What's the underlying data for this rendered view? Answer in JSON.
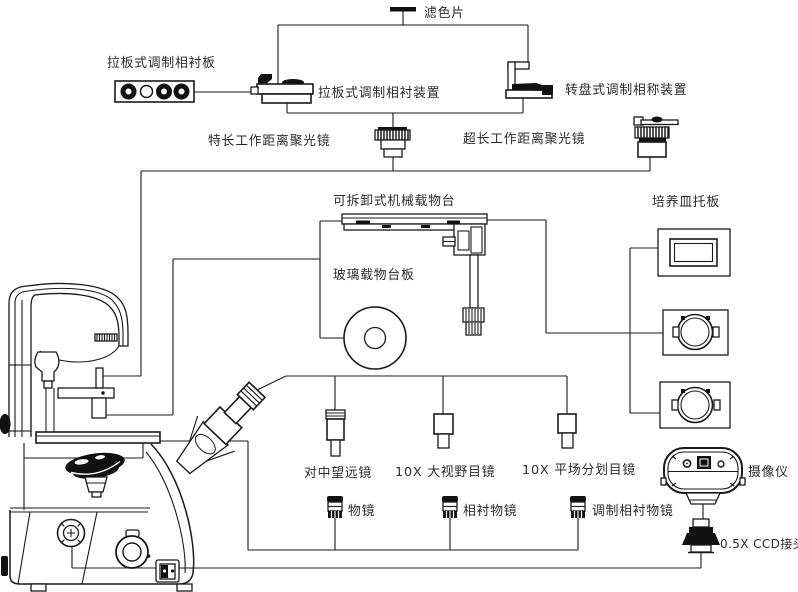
{
  "diagram": {
    "kind": "inverted-microscope-accessory-diagram",
    "colors": {
      "line": "#1a1a1a",
      "dark_fill": "#111111",
      "background": "#ffffff",
      "text": "#2b2b2b"
    },
    "labels": {
      "filter": "滤色片",
      "slider_plate": "拉板式调制相衬板",
      "slider_device": "拉板式调制相衬装置",
      "turret_device": "转盘式调制相称装置",
      "condenser_long": "特长工作距离聚光镜",
      "condenser_ultra": "超长工作距离聚光镜",
      "mech_stage": "可拆卸式机械载物台",
      "petri_holder": "培养皿托板",
      "glass_plate": "玻璃载物台板",
      "telescope": "对中望远镜",
      "eyepiece_widefield": "10X 大视野目镜",
      "eyepiece_reticle": "10X 平场分划目镜",
      "camera": "摄像仪",
      "objective": "物镜",
      "objective_phase": "相衬物镜",
      "objective_modulation": "调制相衬物镜",
      "ccd_adapter": "0.5X CCD接头"
    }
  }
}
